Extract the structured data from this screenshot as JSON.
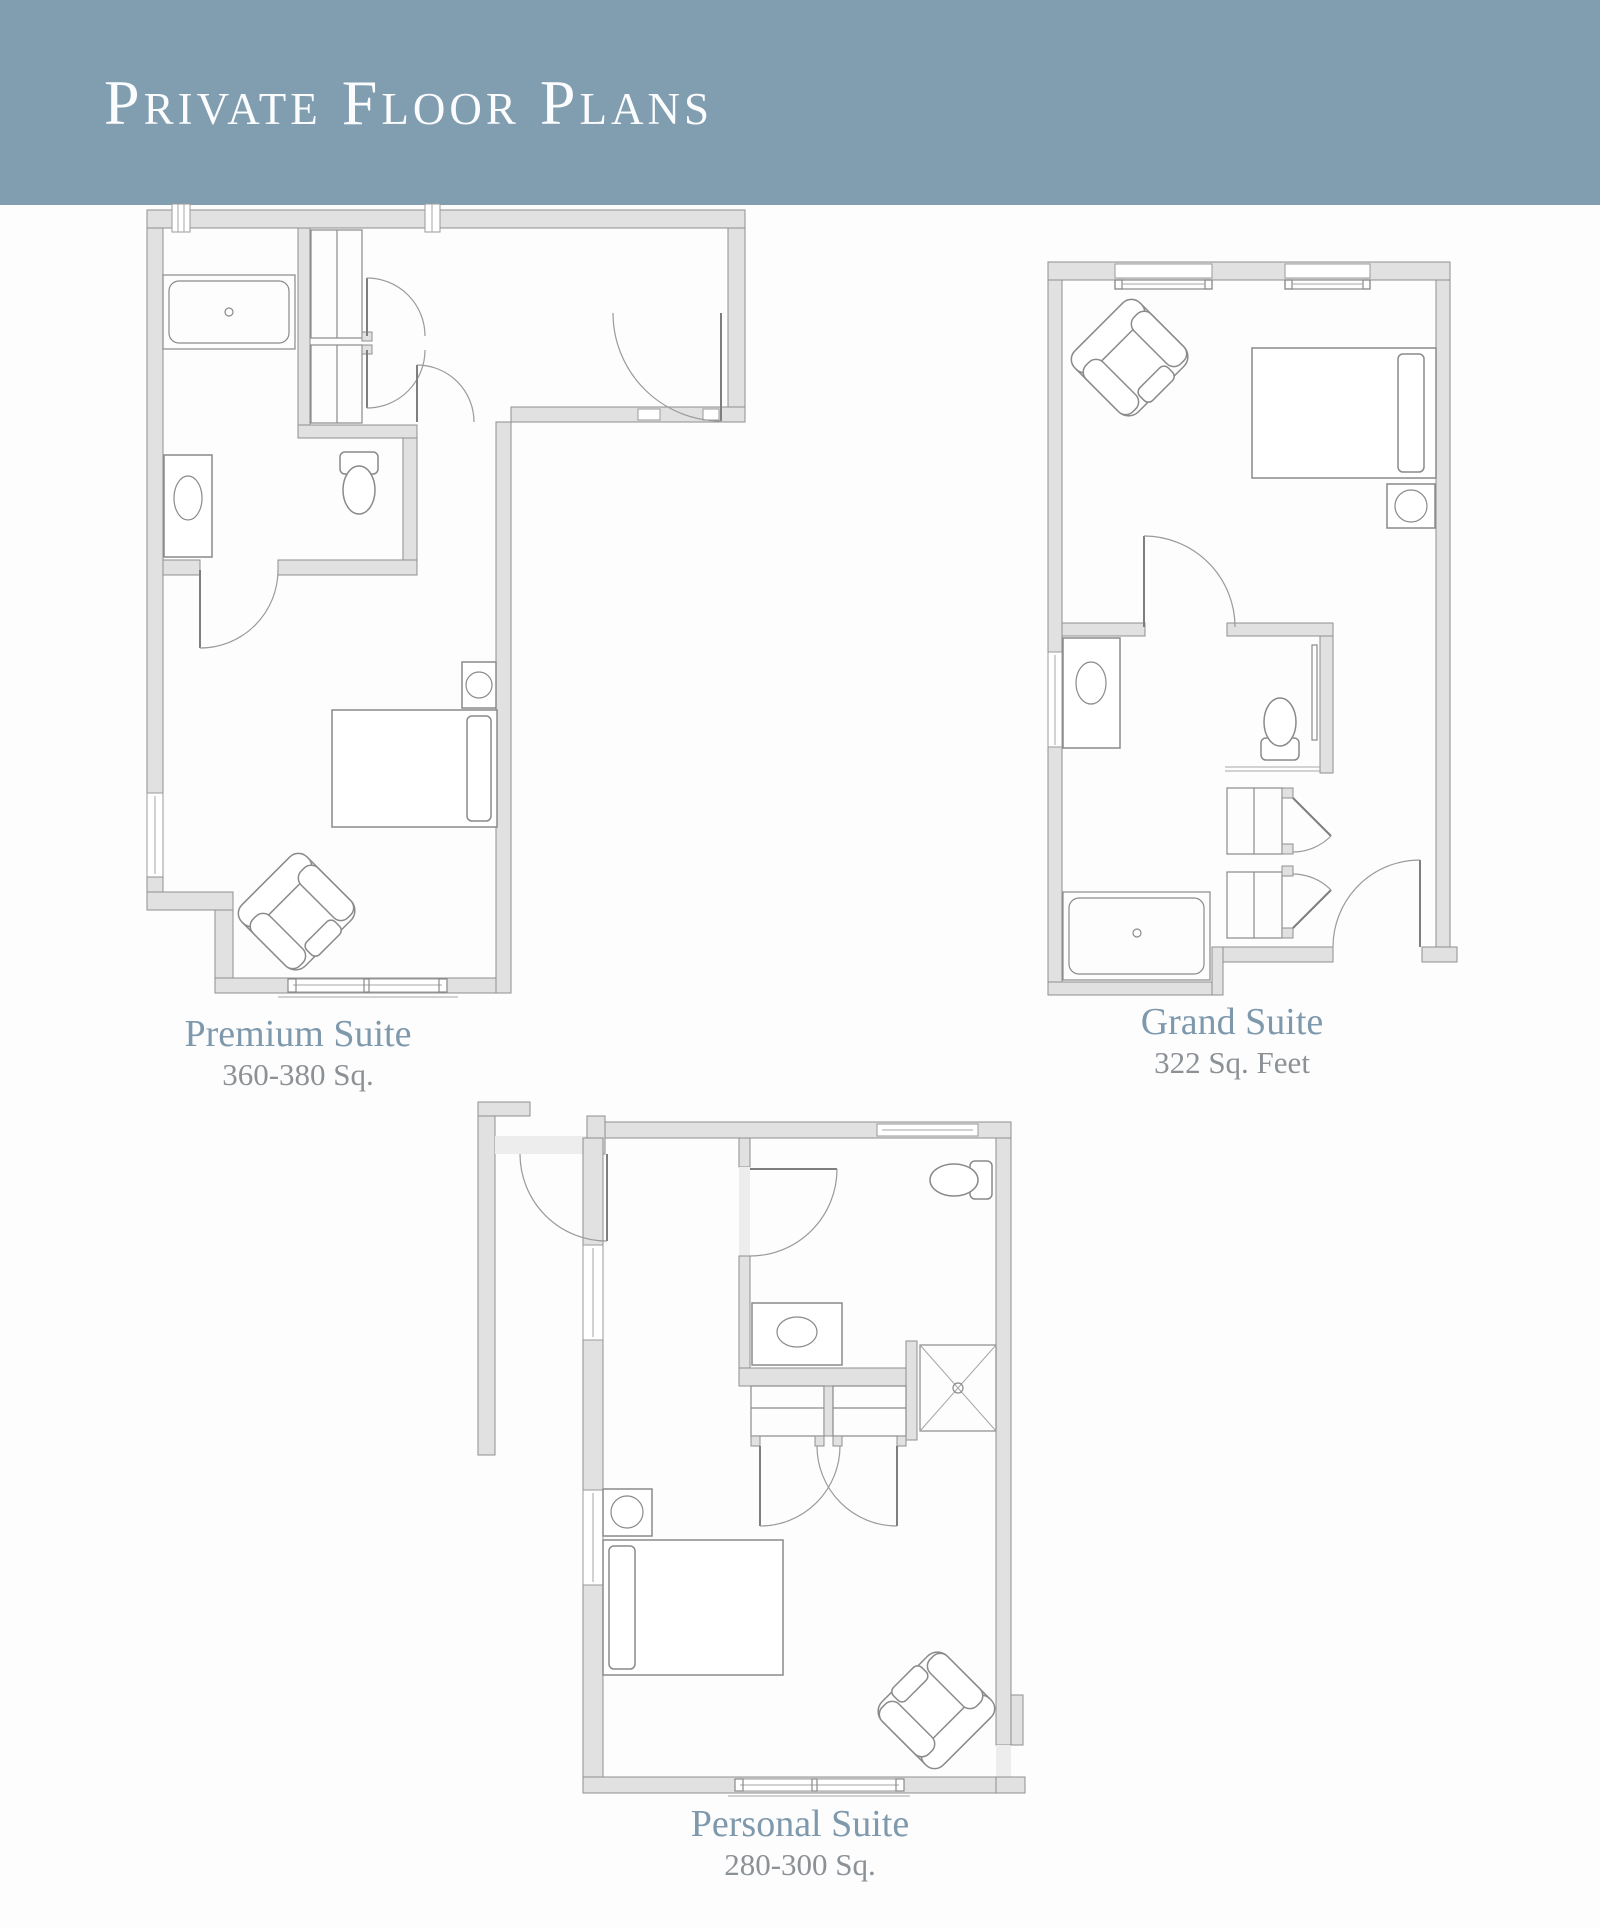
{
  "header": {
    "title": "Private Floor Plans"
  },
  "plans": [
    {
      "id": "premium",
      "name": "Premium Suite",
      "area": "360-380 Sq."
    },
    {
      "id": "grand",
      "name": "Grand Suite",
      "area": "322 Sq. Feet"
    },
    {
      "id": "personal",
      "name": "Personal Suite",
      "area": "280-300 Sq."
    }
  ],
  "colors": {
    "banner": "#819DB0",
    "title_text": "#FBFCFD",
    "plan_name_text": "#7E98AC",
    "plan_area_text": "#8C9196",
    "wall_fill": "#E1E1E1",
    "wall_line": "#8F8F8F",
    "background": "#FDFDFE"
  }
}
